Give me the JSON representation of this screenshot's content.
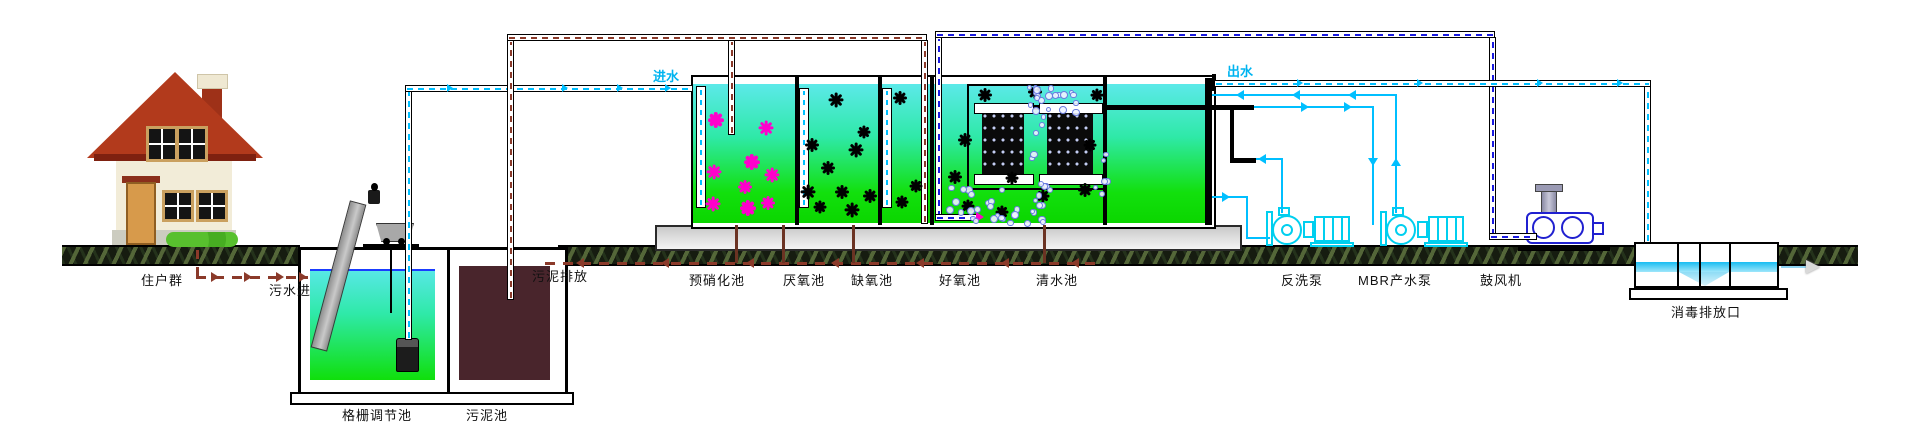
{
  "source_label": "住户群",
  "flow_labels": {
    "sewage_in": "污水进",
    "inflow": "进水",
    "outflow": "出水",
    "sludge_discharge": "污泥排放"
  },
  "pretreatment": {
    "screen_tank_label": "格栅调节池",
    "sludge_tank_label": "污泥池"
  },
  "bioreactor_compartments": [
    {
      "label": "预硝化池"
    },
    {
      "label": "厌氧池"
    },
    {
      "label": "缺氧池"
    },
    {
      "label": "好氧池"
    },
    {
      "label": "清水池"
    }
  ],
  "equipment": {
    "backwash_pump_label": "反洗泵",
    "mbr_pump_label": "MBR产水泵",
    "blower_label": "鼓风机"
  },
  "discharge": {
    "disinfection_outlet_label": "消毒排放口"
  },
  "colors": {
    "inflow_line": "#00BFFF",
    "outflow_line": "#00BFFF",
    "air_line": "#1A1AE0",
    "sludge_line": "#8B3A2A",
    "equipment_outline": "#00CFEF",
    "floc_primary": "#FF00CC",
    "floc_secondary": "#000000",
    "water_top": "#5CE9E9",
    "water_bottom": "#0BD600",
    "sludge_fill": "#49252C"
  }
}
